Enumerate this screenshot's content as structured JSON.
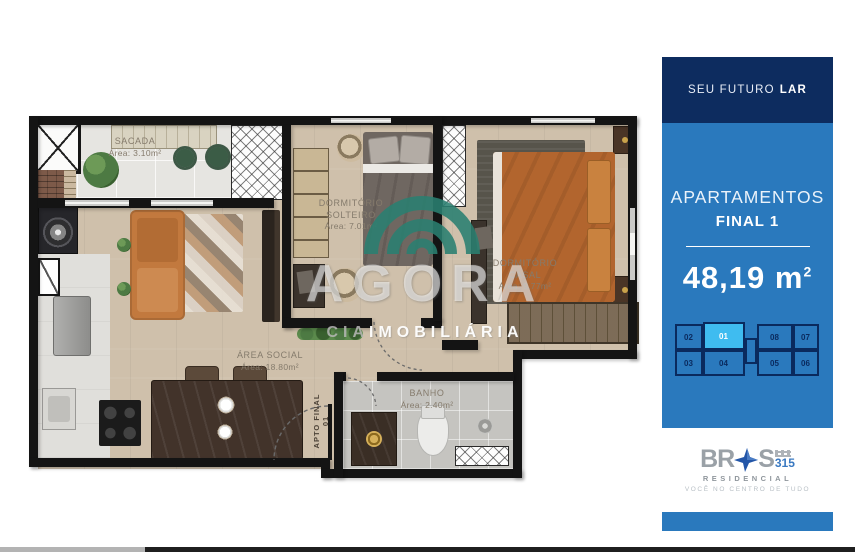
{
  "plan": {
    "rooms": {
      "sacada": {
        "name": "SACADA",
        "area": "Área: 3.10m²"
      },
      "solteiro": {
        "line1": "DORMITÓRIO",
        "line2": "SOLTEIRO",
        "area": "Área: 7.01m²"
      },
      "casal": {
        "line1": "DORMITÓRIO",
        "line2": "CASAL",
        "area": "Área: 9.77m²"
      },
      "social": {
        "name": "ÁREA SOCIAL",
        "area": "Área: 18.80m²"
      },
      "banho": {
        "name": "BANHO",
        "area": "Área: 2.40m²"
      }
    },
    "entrance": {
      "line1": "APTO FINAL",
      "line2": "01"
    }
  },
  "watermark": {
    "brand": "AGORA",
    "cia": "CIA",
    "imobiliaria": "IMOBILIÁRIA",
    "arc_color": "#2a8071"
  },
  "sidebar": {
    "header": {
      "regular": "SEU FUTURO",
      "bold": "LAR"
    },
    "title": "APARTAMENTOS",
    "subtitle": "FINAL 1",
    "area": {
      "value": "48,19",
      "unit": "m",
      "sup": "2"
    },
    "floorplate": {
      "selected": "01",
      "top": [
        "02",
        "01",
        "08",
        "07"
      ],
      "bottom": [
        "03",
        "04",
        "05",
        "06"
      ]
    },
    "colors": {
      "navy": "#0d2c5f",
      "blue": "#2a79bd",
      "highlight": "#3fbcf0"
    }
  },
  "brand": {
    "letters_left": "BR",
    "letters_right": "S",
    "number": "315",
    "residencial": "RESIDENCIAL",
    "tagline": "VOCÊ NO CENTRO DE TUDO",
    "star_color": "#2356a8"
  }
}
